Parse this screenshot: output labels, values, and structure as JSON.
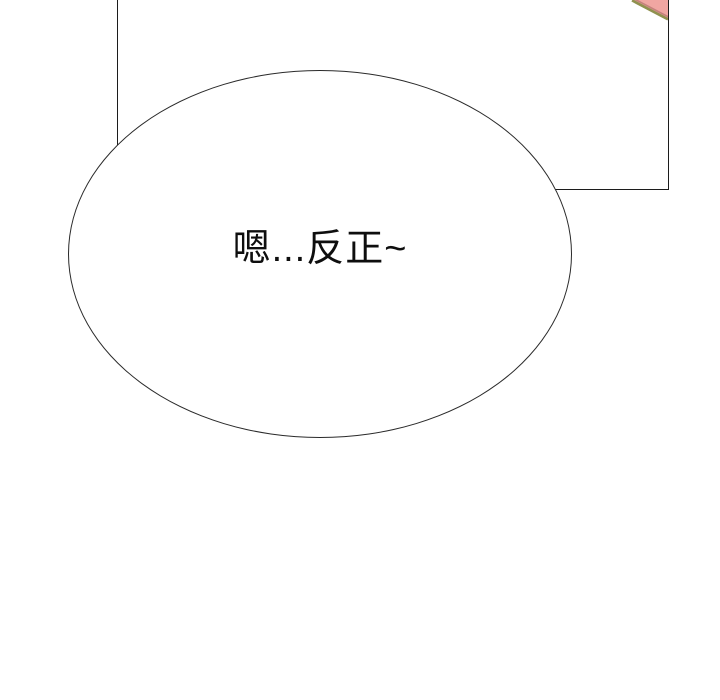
{
  "scene": {
    "type": "comic-panel",
    "background_color": "#ffffff",
    "outline_color": "#1c1c1c"
  },
  "speech_bubble": {
    "text": "嗯...反正~",
    "fill_color": "#ffffff",
    "border_color": "#2a2a2a",
    "text_color": "#0e0e0e"
  },
  "corner_artwork": {
    "fill_color": "#f0a6a2",
    "inner_edge_color": "#c4827c",
    "outer_edge_color": "#90914f"
  }
}
